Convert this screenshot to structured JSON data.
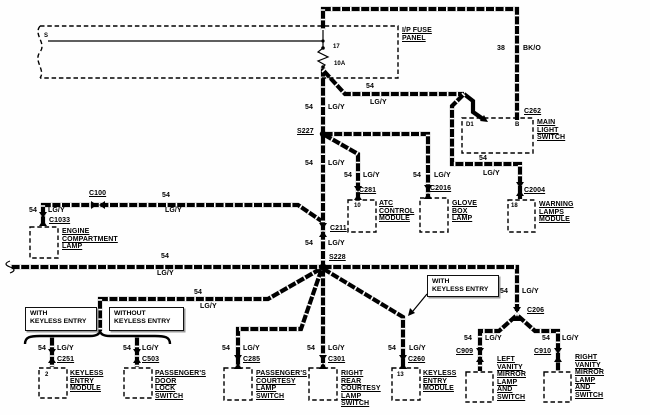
{
  "w": {
    "n": "54",
    "c": "LG/Y"
  },
  "b": {
    "n": "38",
    "c": "BK/O"
  },
  "fp": {
    "name": "I/P FUSE\nPANEL",
    "fuse": "17",
    "amp": "10A",
    "bus": "S"
  },
  "sp": {
    "s227": "S227",
    "s228": "S228"
  },
  "cn": {
    "c100": "C100",
    "c1033": "C1033",
    "c211": "C211",
    "c262": "C262",
    "c281": "C281",
    "c2016": "C2016",
    "c2004": "C2004",
    "c206": "C206",
    "c251": "C251",
    "c503": "C503",
    "c285": "C285",
    "c301": "C301",
    "c260": "C260",
    "c909": "C909",
    "c910": "C910"
  },
  "pin": {
    "d1": "D1",
    "b": "B",
    "atc": "10",
    "warning": "18",
    "keylessL": "2",
    "keylessR": "13"
  },
  "cm": {
    "engineLamp": "ENGINE\nCOMPARTMENT\nLAMP",
    "mainLightSwitch": "MAIN\nLIGHT\nSWITCH",
    "atc": "ATC\nCONTROL\nMODULE",
    "gloveBox": "GLOVE\nBOX\nLAMP",
    "warning": "WARNING\nLAMPS\nMODULE",
    "keylessL": "KEYLESS\nENTRY\nMODULE",
    "doorLock": "PASSENGER'S\nDOOR\nLOCK\nSWITCH",
    "courtesy": "PASSENGER'S\nCOURTESY\nLAMP\nSWITCH",
    "rearCourtesy": "RIGHT\nREAR\nCOURTESY\nLAMP\nSWITCH",
    "keylessR": "KEYLESS\nENTRY\nMODULE",
    "leftVanity": "LEFT\nVANITY\nMIRROR\nLAMP\nAND\nSWITCH",
    "rightVanity": "RIGHT\nVANITY\nMIRROR\nLAMP\nAND\nSWITCH"
  },
  "an": {
    "with": "WITH\nKEYLESS ENTRY",
    "without": "WITHOUT\nKEYLESS ENTRY"
  },
  "colors": {
    "wire": "#000000",
    "background": "#fefefe"
  }
}
